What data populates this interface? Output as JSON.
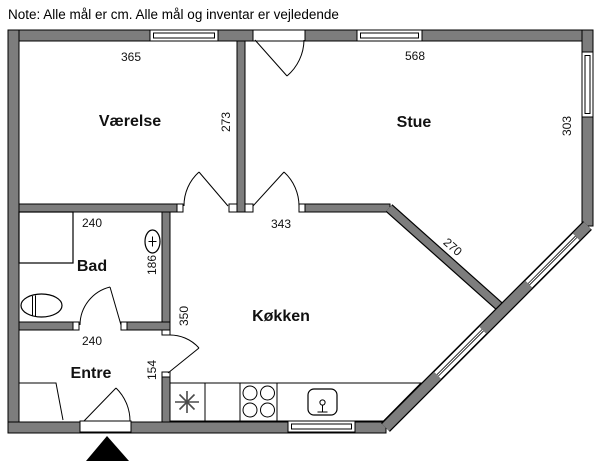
{
  "note": "Note: Alle mål er cm. Alle mål og inventar er vejledende",
  "rooms": {
    "vaerelse": "Værelse",
    "stue": "Stue",
    "bad": "Bad",
    "entre": "Entre",
    "koekken": "Køkken"
  },
  "dimensions": {
    "vaerelse_width": "365",
    "stue_width": "568",
    "vaerelse_depth": "273",
    "stue_depth": "303",
    "koekken_opening": "343",
    "koekken_diagonal": "270",
    "bad_width": "240",
    "bad_depth": "186",
    "entre_width": "240",
    "koekken_depth": "350",
    "entre_passage": "154"
  },
  "colors": {
    "wall": "#7d7d7d",
    "outline": "#000000",
    "background": "#ffffff"
  },
  "icons": {
    "entrance_marker": "entrance-arrow",
    "freezer": "freezer-asterisk",
    "stove": "stove-burners",
    "kitchen_sink": "kitchen-sink",
    "washbasin": "washbasin",
    "toilet": "toilet",
    "shower": "shower-cabinet"
  }
}
